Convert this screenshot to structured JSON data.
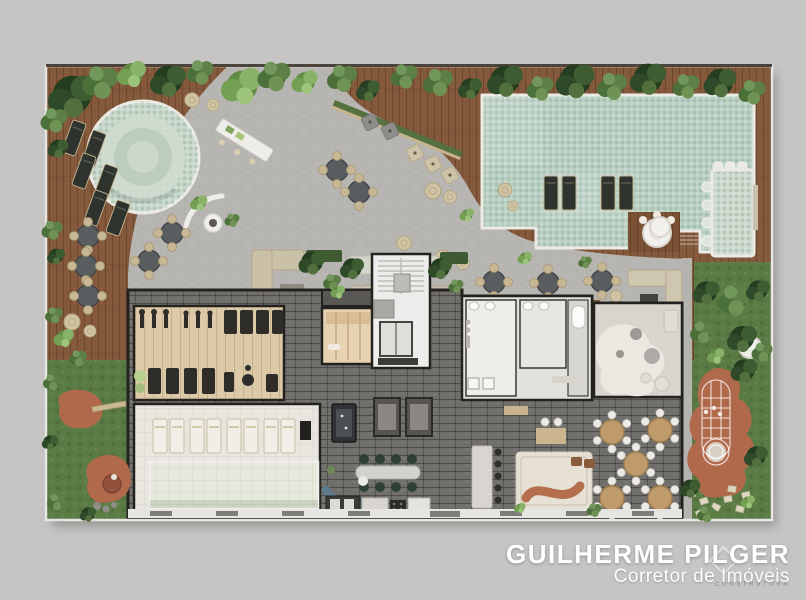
{
  "branding": {
    "agent_name": "GUILHERME PILGER",
    "agent_title": "Corretor de Imóveis",
    "watermark_letter": "D",
    "watermark_tagline": "CONSTRUTORA",
    "text_color": "#ffffff"
  },
  "palette": {
    "canvas_bg": "#c6c5c3",
    "deck_wood": "#855a3c",
    "concrete": "#b7b5b2",
    "pool_water": "#b9cfc2",
    "spa_water": "#c6d6c9",
    "plunge_pool": "#ccd8cc",
    "lap_pool": "#e4e9db",
    "grass": "#5b7b45",
    "terracotta": "#b1694c",
    "stone_dark": "#716f6c",
    "gym_floor": "#dcc9a7",
    "room_light": "#e9e6e0",
    "zen_floor": "#d8d5cf",
    "sauna_floor": "#e7d3b2",
    "plant_green": "#4c7039"
  }
}
